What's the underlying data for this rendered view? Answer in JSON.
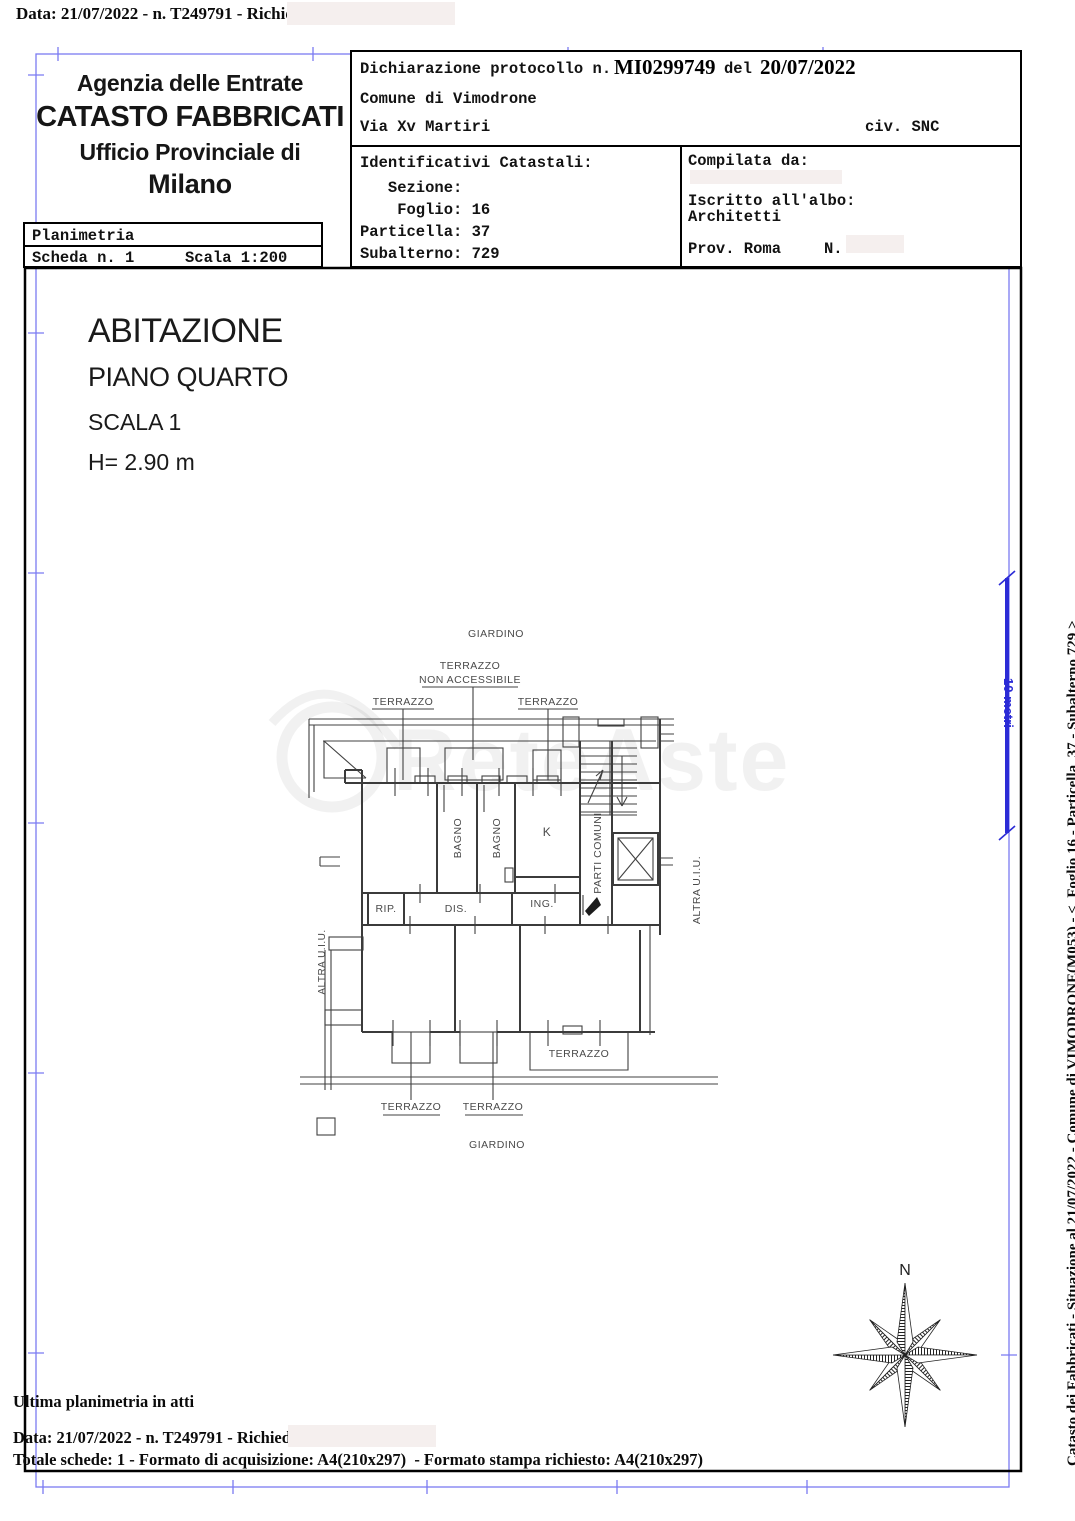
{
  "colors": {
    "frame_blue": "#7b7bf2",
    "scale_blue": "#2b2bd6",
    "redaction": "#f5efee",
    "wall_gray": "#414141",
    "watermark_alpha": "rgba(0,0,0,0.055)"
  },
  "top_line": "Data: 21/07/2022 - n. T249791 - Richiedente:",
  "header": {
    "agency": [
      "Agenzia delle Entrate",
      "CATASTO FABBRICATI",
      "Ufficio Provinciale di",
      "Milano"
    ],
    "planimetria": {
      "title": "Planimetria",
      "scheda": "Scheda n. 1",
      "scala": "Scala 1:200"
    }
  },
  "declaration": {
    "protocol_prefix": "Dichiarazione protocollo n.",
    "protocol_number": "MI0299749",
    "del_label": "del",
    "protocol_date": "20/07/2022",
    "comune": "Comune di Vimodrone",
    "via": "Via Xv Martiri",
    "civ": "civ. SNC",
    "identificativi": {
      "title": "Identificativi Catastali:",
      "sezione": "   Sezione:",
      "foglio": "    Foglio: 16",
      "particella": "Particella: 37",
      "subalterno": "Subalterno: 729"
    },
    "compilata": {
      "label": "Compilata da:",
      "albo_line1": "Iscritto all'albo:",
      "albo_line2": "Architetti",
      "prov": "Prov. Roma",
      "n_label": "N."
    }
  },
  "title_block": {
    "line1": "ABITAZIONE",
    "line2": "PIANO QUARTO",
    "line3": "SCALA 1",
    "line4": "H= 2.90 m"
  },
  "floorplan": {
    "giardino_top": "GIARDINO",
    "terrazzo_na_1": "TERRAZZO",
    "terrazzo_na_2": "NON ACCESSIBILE",
    "terrazzo_left": "TERRAZZO",
    "terrazzo_right": "TERRAZZO",
    "bagno1": "BAGNO",
    "bagno2": "BAGNO",
    "k": "K",
    "parti_comuni": "PARTI COMUNI",
    "rip": "RIP.",
    "dis": "DIS.",
    "ing": "ING.",
    "altra_uiu_left": "ALTRA U.I.U.",
    "altra_uiu_right": "ALTRA U.I.U.",
    "terrazzo_inner": "TERRAZZO",
    "terrazzo_bottom1": "TERRAZZO",
    "terrazzo_bottom2": "TERRAZZO",
    "giardino_bottom": "GIARDINO"
  },
  "watermark": "ReteAste",
  "scale_bar": {
    "label": "10 metri"
  },
  "compass": {
    "label": "N"
  },
  "side_caption": {
    "line1": "Catasto dei Fabbricati - Situazione al 21/07/2022 - Comune di VIMODRONE(M053) - <  Foglio 16 - Particella  37 - Subalterno 729 >",
    "line2": "VIA XV MARTIRI n. SNC  Scala 1 Piano 4"
  },
  "footer": {
    "line1": "Ultima planimetria in atti",
    "line2": "Data: 21/07/2022 - n. T249791 - Richiedente:",
    "line3": "Totale schede: 1 - Formato di acquisizione: A4(210x297)  - Formato stampa richiesto: A4(210x297)"
  }
}
